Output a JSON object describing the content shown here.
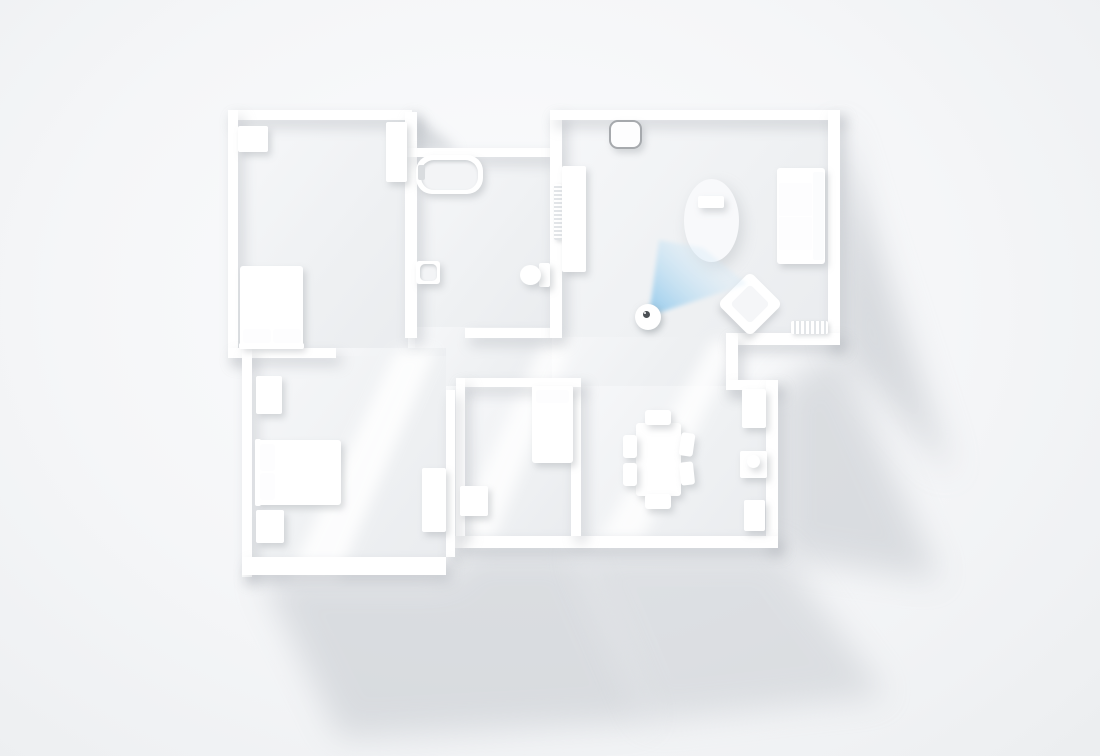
{
  "scene": {
    "description": "Top-down 3D render of white apartment floor plan with smart motion sensor and blue detection cone",
    "canvas": {
      "width": 1100,
      "height": 756
    }
  },
  "palette": {
    "wall": "#ffffff",
    "furniture": "#ffffff",
    "floor_light": "#f6f7f9",
    "floor_dark": "#eaecef",
    "exterior_shadow": "#b9bec4",
    "light_shaft": "#ffffff",
    "lamp_ring": "#a6a9ad",
    "lens": "#4b5054",
    "cone_near": "rgba(140,198,234,0.95)",
    "cone_far": "rgba(210,233,248,0.35)"
  },
  "floors": [
    {
      "name": "bedroom-1-floor",
      "x": 238,
      "y": 118,
      "w": 170,
      "h": 234
    },
    {
      "name": "bathroom-floor",
      "x": 415,
      "y": 155,
      "w": 137,
      "h": 175
    },
    {
      "name": "living-room-floor",
      "x": 560,
      "y": 118,
      "w": 270,
      "h": 219
    },
    {
      "name": "hallway-floor-a",
      "x": 415,
      "y": 327,
      "w": 137,
      "h": 59
    },
    {
      "name": "hallway-floor-b",
      "x": 336,
      "y": 348,
      "w": 110,
      "h": 38
    },
    {
      "name": "living-dining-connector-floor",
      "x": 552,
      "y": 337,
      "w": 178,
      "h": 49
    },
    {
      "name": "bedroom-2-floor",
      "x": 250,
      "y": 356,
      "w": 196,
      "h": 203
    },
    {
      "name": "bedroom-3-floor",
      "x": 464,
      "y": 386,
      "w": 108,
      "h": 152
    },
    {
      "name": "dining-kitchen-floor",
      "x": 580,
      "y": 386,
      "w": 188,
      "h": 152
    }
  ],
  "walls": [
    {
      "name": "wall-bedroom1-top",
      "x": 228,
      "y": 110,
      "w": 184,
      "h": 10
    },
    {
      "name": "wall-bedroom1-left",
      "x": 228,
      "y": 110,
      "w": 10,
      "h": 248
    },
    {
      "name": "wall-bedroom1-bottom",
      "x": 228,
      "y": 348,
      "w": 108,
      "h": 10
    },
    {
      "name": "wall-bedroom1-bathroom-divider",
      "x": 405,
      "y": 112,
      "w": 12,
      "h": 226
    },
    {
      "name": "wall-bathroom-top",
      "x": 405,
      "y": 148,
      "w": 147,
      "h": 9
    },
    {
      "name": "wall-bathroom-bottom",
      "x": 465,
      "y": 328,
      "w": 87,
      "h": 10
    },
    {
      "name": "wall-living-left",
      "x": 550,
      "y": 110,
      "w": 12,
      "h": 228
    },
    {
      "name": "wall-living-top",
      "x": 550,
      "y": 110,
      "w": 290,
      "h": 10
    },
    {
      "name": "wall-living-right",
      "x": 828,
      "y": 110,
      "w": 12,
      "h": 235
    },
    {
      "name": "wall-living-bottom",
      "x": 726,
      "y": 333,
      "w": 114,
      "h": 12
    },
    {
      "name": "wall-stub-vertical",
      "x": 726,
      "y": 333,
      "w": 12,
      "h": 56
    },
    {
      "name": "wall-dining-top-right",
      "x": 726,
      "y": 380,
      "w": 52,
      "h": 10
    },
    {
      "name": "wall-dining-right",
      "x": 766,
      "y": 380,
      "w": 12,
      "h": 168
    },
    {
      "name": "wall-bottom-long",
      "x": 455,
      "y": 536,
      "w": 323,
      "h": 12
    },
    {
      "name": "wall-bedroom3-dining-divider",
      "x": 571,
      "y": 380,
      "w": 10,
      "h": 156
    },
    {
      "name": "wall-bedroom3-top",
      "x": 456,
      "y": 378,
      "w": 125,
      "h": 9
    },
    {
      "name": "wall-bedroom3-left",
      "x": 456,
      "y": 378,
      "w": 9,
      "h": 158
    },
    {
      "name": "wall-bedroom2-right",
      "x": 446,
      "y": 390,
      "w": 9,
      "h": 167
    },
    {
      "name": "wall-bedroom2-left",
      "x": 242,
      "y": 348,
      "w": 10,
      "h": 229
    },
    {
      "name": "wall-bedroom2-bottom",
      "x": 242,
      "y": 557,
      "w": 204,
      "h": 18
    }
  ],
  "exterior_shadows": [
    {
      "name": "shadow-right-of-living",
      "points": [
        [
          838,
          118
        ],
        [
          874,
          234
        ],
        [
          952,
          476
        ],
        [
          838,
          348
        ]
      ],
      "opacity": 0.5,
      "blur": 16
    },
    {
      "name": "shadow-right-of-dining",
      "points": [
        [
          778,
          388
        ],
        [
          838,
          348
        ],
        [
          940,
          580
        ],
        [
          800,
          560
        ],
        [
          778,
          548
        ]
      ],
      "opacity": 0.45,
      "blur": 16
    },
    {
      "name": "shadow-below-bedroom2",
      "points": [
        [
          260,
          575
        ],
        [
          446,
          575
        ],
        [
          470,
          548
        ],
        [
          575,
          548
        ],
        [
          650,
          722
        ],
        [
          340,
          738
        ]
      ],
      "opacity": 0.45,
      "blur": 16
    },
    {
      "name": "shadow-below-dining",
      "points": [
        [
          575,
          548
        ],
        [
          778,
          548
        ],
        [
          886,
          696
        ],
        [
          648,
          722
        ]
      ],
      "opacity": 0.4,
      "blur": 16
    },
    {
      "name": "shadow-notch-above-bathroom",
      "points": [
        [
          412,
          112
        ],
        [
          458,
          150
        ],
        [
          412,
          150
        ]
      ],
      "opacity": 0.5,
      "blur": 6
    }
  ],
  "light_shafts": [
    {
      "name": "light-shaft-hallway",
      "points": [
        [
          396,
          350
        ],
        [
          436,
          350
        ],
        [
          338,
          577
        ],
        [
          288,
          577
        ]
      ],
      "opacity": 0.85,
      "blur": 7
    },
    {
      "name": "light-shaft-corridor",
      "points": [
        [
          544,
          338
        ],
        [
          574,
          338
        ],
        [
          494,
          538
        ],
        [
          452,
          538
        ]
      ],
      "opacity": 0.8,
      "blur": 7
    },
    {
      "name": "light-shaft-dining",
      "points": [
        [
          712,
          340
        ],
        [
          740,
          340
        ],
        [
          642,
          540
        ],
        [
          598,
          540
        ]
      ],
      "opacity": 0.8,
      "blur": 7
    }
  ],
  "furniture": [
    {
      "name": "bedroom1-dresser",
      "x": 238,
      "y": 126,
      "w": 30,
      "h": 26
    },
    {
      "name": "bedroom1-closet",
      "x": 386,
      "y": 122,
      "w": 21,
      "h": 60
    },
    {
      "name": "bedroom1-bed",
      "x": 240,
      "y": 266,
      "w": 63,
      "h": 82,
      "r": 3
    },
    {
      "name": "bedroom1-headboard",
      "x": 239,
      "y": 343,
      "w": 65,
      "h": 6,
      "cls": "flat"
    },
    {
      "name": "bedroom1-pillow-left",
      "x": 243,
      "y": 329,
      "w": 28,
      "h": 14,
      "r": 3,
      "cls": "flat",
      "bg": "#fdfdfe"
    },
    {
      "name": "bedroom1-pillow-right",
      "x": 273,
      "y": 329,
      "w": 28,
      "h": 14,
      "r": 3,
      "cls": "flat",
      "bg": "#fdfdfe"
    },
    {
      "name": "bathtub",
      "x": 416,
      "y": 155,
      "w": 67,
      "h": 39,
      "r": 16
    },
    {
      "name": "bathtub-basin",
      "x": 421,
      "y": 160,
      "w": 57,
      "h": 30,
      "r": 13,
      "cls": "inset",
      "bg": "#f3f4f6"
    },
    {
      "name": "bathtub-faucet",
      "x": 418,
      "y": 165,
      "w": 7,
      "h": 15,
      "r": 2,
      "cls": "flat",
      "bg": "#d9dcdf"
    },
    {
      "name": "bathroom-sink",
      "x": 416,
      "y": 261,
      "w": 24,
      "h": 23,
      "r": 3
    },
    {
      "name": "bathroom-sink-basin",
      "x": 420,
      "y": 264,
      "w": 17,
      "h": 17,
      "r": 5,
      "cls": "inset",
      "bg": "#f3f4f6"
    },
    {
      "name": "toilet-tank",
      "x": 539,
      "y": 263,
      "w": 11,
      "h": 24
    },
    {
      "name": "toilet-bowl",
      "x": 520,
      "y": 265,
      "w": 21,
      "h": 20,
      "r": "50%"
    },
    {
      "name": "ceiling-lamp",
      "x": 609,
      "y": 120,
      "w": 29,
      "h": 25,
      "r": 9,
      "cls": "ring"
    },
    {
      "name": "living-wall-radiator",
      "x": 554,
      "y": 184,
      "w": 8,
      "h": 56,
      "cls": "ribbed-h"
    },
    {
      "name": "media-console",
      "x": 562,
      "y": 166,
      "w": 24,
      "h": 106,
      "r": 2
    },
    {
      "name": "rug",
      "x": 684,
      "y": 179,
      "w": 55,
      "h": 83,
      "r": "50%",
      "cls": "soft",
      "bg": "#f8f9fb"
    },
    {
      "name": "coffee-table",
      "x": 698,
      "y": 196,
      "w": 26,
      "h": 12,
      "r": 2
    },
    {
      "name": "sofa-base",
      "x": 777,
      "y": 168,
      "w": 48,
      "h": 96,
      "r": 3
    },
    {
      "name": "sofa-back",
      "x": 813,
      "y": 172,
      "w": 11,
      "h": 88,
      "cls": "flat",
      "bg": "#fbfcfd"
    },
    {
      "name": "sofa-arm-top",
      "x": 778,
      "y": 168,
      "w": 35,
      "h": 13,
      "r": 3,
      "cls": "flat"
    },
    {
      "name": "sofa-arm-bottom",
      "x": 778,
      "y": 251,
      "w": 35,
      "h": 13,
      "r": 3,
      "cls": "flat"
    },
    {
      "name": "sofa-seat-cushion-1",
      "x": 779,
      "y": 183,
      "w": 33,
      "h": 33,
      "r": 2,
      "cls": "flat",
      "bg": "#fdfdfe"
    },
    {
      "name": "sofa-seat-cushion-2",
      "x": 779,
      "y": 217,
      "w": 33,
      "h": 33,
      "r": 2,
      "cls": "flat",
      "bg": "#fdfdfe"
    },
    {
      "name": "armchair",
      "x": 727,
      "y": 281,
      "w": 46,
      "h": 46,
      "r": 6,
      "rot": 45
    },
    {
      "name": "armchair-seat",
      "x": 736,
      "y": 290,
      "w": 28,
      "h": 28,
      "r": 4,
      "rot": 45,
      "cls": "flat",
      "bg": "#f5f6f8"
    },
    {
      "name": "living-radiator",
      "x": 791,
      "y": 321,
      "w": 37,
      "h": 13,
      "cls": "ribbed-v"
    },
    {
      "name": "bedroom3-bed",
      "x": 532,
      "y": 386,
      "w": 41,
      "h": 77,
      "r": 3
    },
    {
      "name": "bedroom3-headboard",
      "x": 532,
      "y": 386,
      "w": 41,
      "h": 5,
      "cls": "flat"
    },
    {
      "name": "bedroom3-pillow",
      "x": 536,
      "y": 390,
      "w": 33,
      "h": 13,
      "r": 3,
      "cls": "flat",
      "bg": "#fdfdfe"
    },
    {
      "name": "bedroom3-cabinet",
      "x": 460,
      "y": 486,
      "w": 28,
      "h": 30
    },
    {
      "name": "bedroom2-wardrobe-top",
      "x": 256,
      "y": 376,
      "w": 26,
      "h": 38
    },
    {
      "name": "bedroom2-bed",
      "x": 256,
      "y": 440,
      "w": 85,
      "h": 65,
      "r": 3
    },
    {
      "name": "bedroom2-headboard",
      "x": 255,
      "y": 439,
      "w": 6,
      "h": 67,
      "cls": "flat"
    },
    {
      "name": "bedroom2-pillow-top",
      "x": 260,
      "y": 444,
      "w": 15,
      "h": 27,
      "r": 3,
      "cls": "flat",
      "bg": "#fdfdfe"
    },
    {
      "name": "bedroom2-pillow-bottom",
      "x": 260,
      "y": 473,
      "w": 15,
      "h": 27,
      "r": 3,
      "cls": "flat",
      "bg": "#fdfdfe"
    },
    {
      "name": "bedroom2-nightstand",
      "x": 256,
      "y": 510,
      "w": 28,
      "h": 33
    },
    {
      "name": "bedroom2-wardrobe-right",
      "x": 422,
      "y": 468,
      "w": 24,
      "h": 64
    },
    {
      "name": "dining-table",
      "x": 636,
      "y": 423,
      "w": 45,
      "h": 73,
      "r": 3
    },
    {
      "name": "dining-chair-top",
      "x": 645,
      "y": 410,
      "w": 26,
      "h": 15,
      "r": 3
    },
    {
      "name": "dining-chair-bottom",
      "x": 645,
      "y": 494,
      "w": 26,
      "h": 15,
      "r": 3
    },
    {
      "name": "dining-chair-left-1",
      "x": 623,
      "y": 435,
      "w": 14,
      "h": 23,
      "r": 3
    },
    {
      "name": "dining-chair-left-2",
      "x": 623,
      "y": 463,
      "w": 14,
      "h": 23,
      "r": 3
    },
    {
      "name": "dining-chair-right-1",
      "x": 680,
      "y": 433,
      "w": 14,
      "h": 23,
      "r": 3,
      "rot": 8
    },
    {
      "name": "dining-chair-right-2",
      "x": 680,
      "y": 462,
      "w": 14,
      "h": 23,
      "r": 3,
      "rot": -6
    },
    {
      "name": "kitchen-cabinet-1",
      "x": 742,
      "y": 389,
      "w": 24,
      "h": 39
    },
    {
      "name": "kitchen-cabinet-2",
      "x": 740,
      "y": 451,
      "w": 27,
      "h": 27
    },
    {
      "name": "kitchen-kettle",
      "x": 747,
      "y": 455,
      "w": 13,
      "h": 13,
      "r": "50%"
    },
    {
      "name": "kitchen-cabinet-3",
      "x": 744,
      "y": 500,
      "w": 21,
      "h": 31
    }
  ],
  "sensor": {
    "x": 635,
    "y": 304,
    "size": 26,
    "lens": {
      "x": 8,
      "y": 7,
      "size": 7
    }
  },
  "cone": {
    "points": [
      [
        649,
        316
      ],
      [
        659,
        240
      ],
      [
        703,
        248
      ],
      [
        747,
        284
      ]
    ],
    "gradient": {
      "x1": 649,
      "y1": 316,
      "x2": 705,
      "y2": 260
    },
    "blur": 2
  }
}
